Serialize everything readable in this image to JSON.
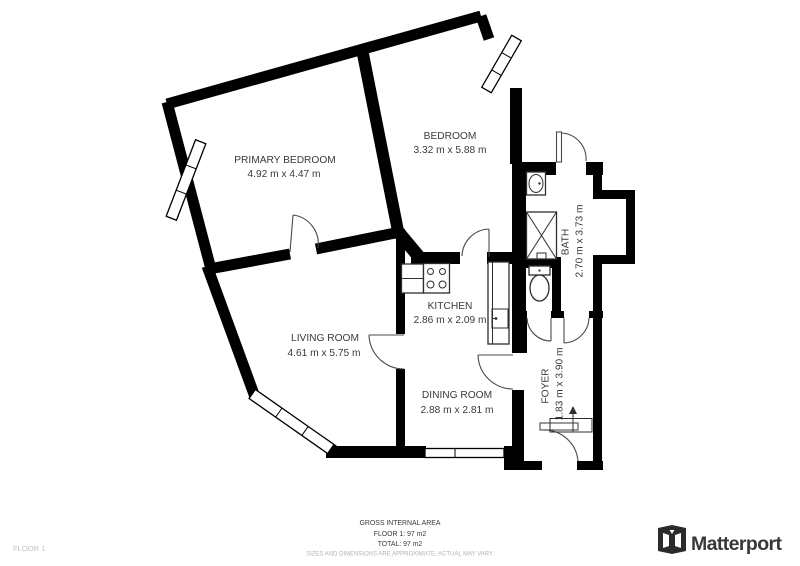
{
  "floorplan": {
    "rooms": {
      "primary_bedroom": {
        "name": "PRIMARY BEDROOM",
        "dims": "4.92 m x 4.47 m"
      },
      "bedroom": {
        "name": "BEDROOM",
        "dims": "3.32 m x 5.88 m"
      },
      "kitchen": {
        "name": "KITCHEN",
        "dims": "2.86 m x 2.09 m"
      },
      "living_room": {
        "name": "LIVING ROOM",
        "dims": "4.61 m x 5.75 m"
      },
      "dining_room": {
        "name": "DINING ROOM",
        "dims": "2.88 m x 2.81 m"
      },
      "bath": {
        "name": "BATH",
        "dims": "2.70 m x 3.73 m"
      },
      "foyer": {
        "name": "FOYER",
        "dims": "1.83 m x 3.90 m"
      }
    },
    "icons": [
      "window-icon",
      "door-arc-icon",
      "stove-icon",
      "sink-icon",
      "toilet-icon",
      "shower-icon",
      "entry-arrow-icon"
    ]
  },
  "footer": {
    "area_title": "GROSS INTERNAL AREA",
    "floor_area_line": "FLOOR 1: 97 m2",
    "total_area_line": "TOTAL: 97 m2",
    "disclaimer": "SIZES AND DIMENSIONS ARE APPROXIMATE, ACTUAL MAY VARY.",
    "floor_label": "FLOOR 1"
  },
  "brand": {
    "name": "Matterport"
  },
  "colors": {
    "wall": "#000000",
    "label_text": "#3a3a3a",
    "muted_text": "#b3b3b3",
    "background": "#ffffff"
  }
}
